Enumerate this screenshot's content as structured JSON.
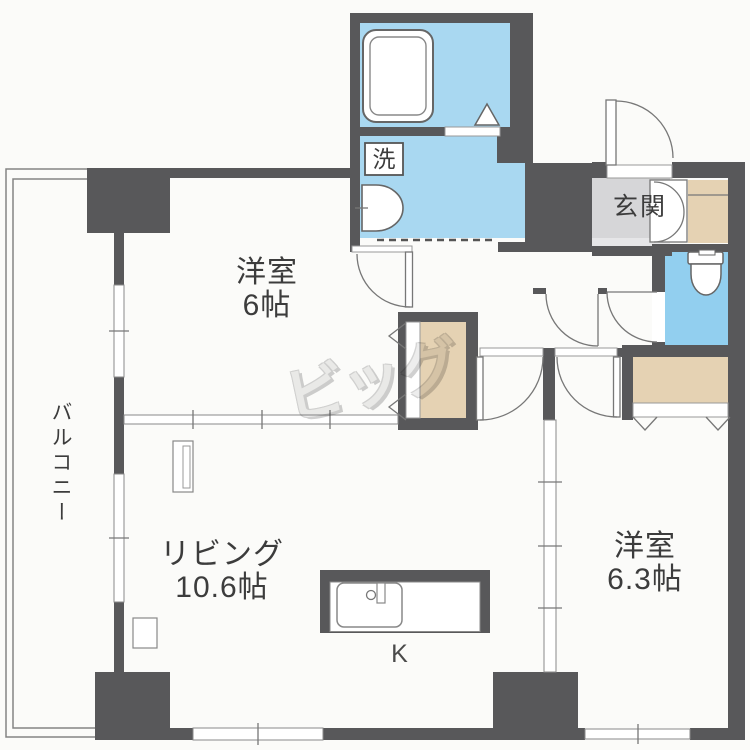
{
  "plan": {
    "rooms": {
      "bedroom_west": {
        "label": "洋室",
        "size": "6帖"
      },
      "living": {
        "label": "リビング",
        "size": "10.6帖"
      },
      "bedroom_east": {
        "label": "洋室",
        "size": "6.3帖"
      },
      "kitchen": {
        "label": "K"
      },
      "entrance": {
        "label": "玄関"
      },
      "balcony": {
        "label": "バルコニー"
      },
      "laundry_mark": {
        "label": "洗"
      }
    },
    "watermark": {
      "label": "ビッグ"
    }
  },
  "colors": {
    "wall": "#58585a",
    "water-room": "#a9d8f1",
    "toilet-room": "#92cfef",
    "closet": "#e5d2b3",
    "entrance-floor": "#d6d6d8",
    "entrance-step": "#e6e6e8",
    "line": "#777777",
    "label-text": "#3c3c3c",
    "watermark-gray": "#dcdcdc"
  }
}
